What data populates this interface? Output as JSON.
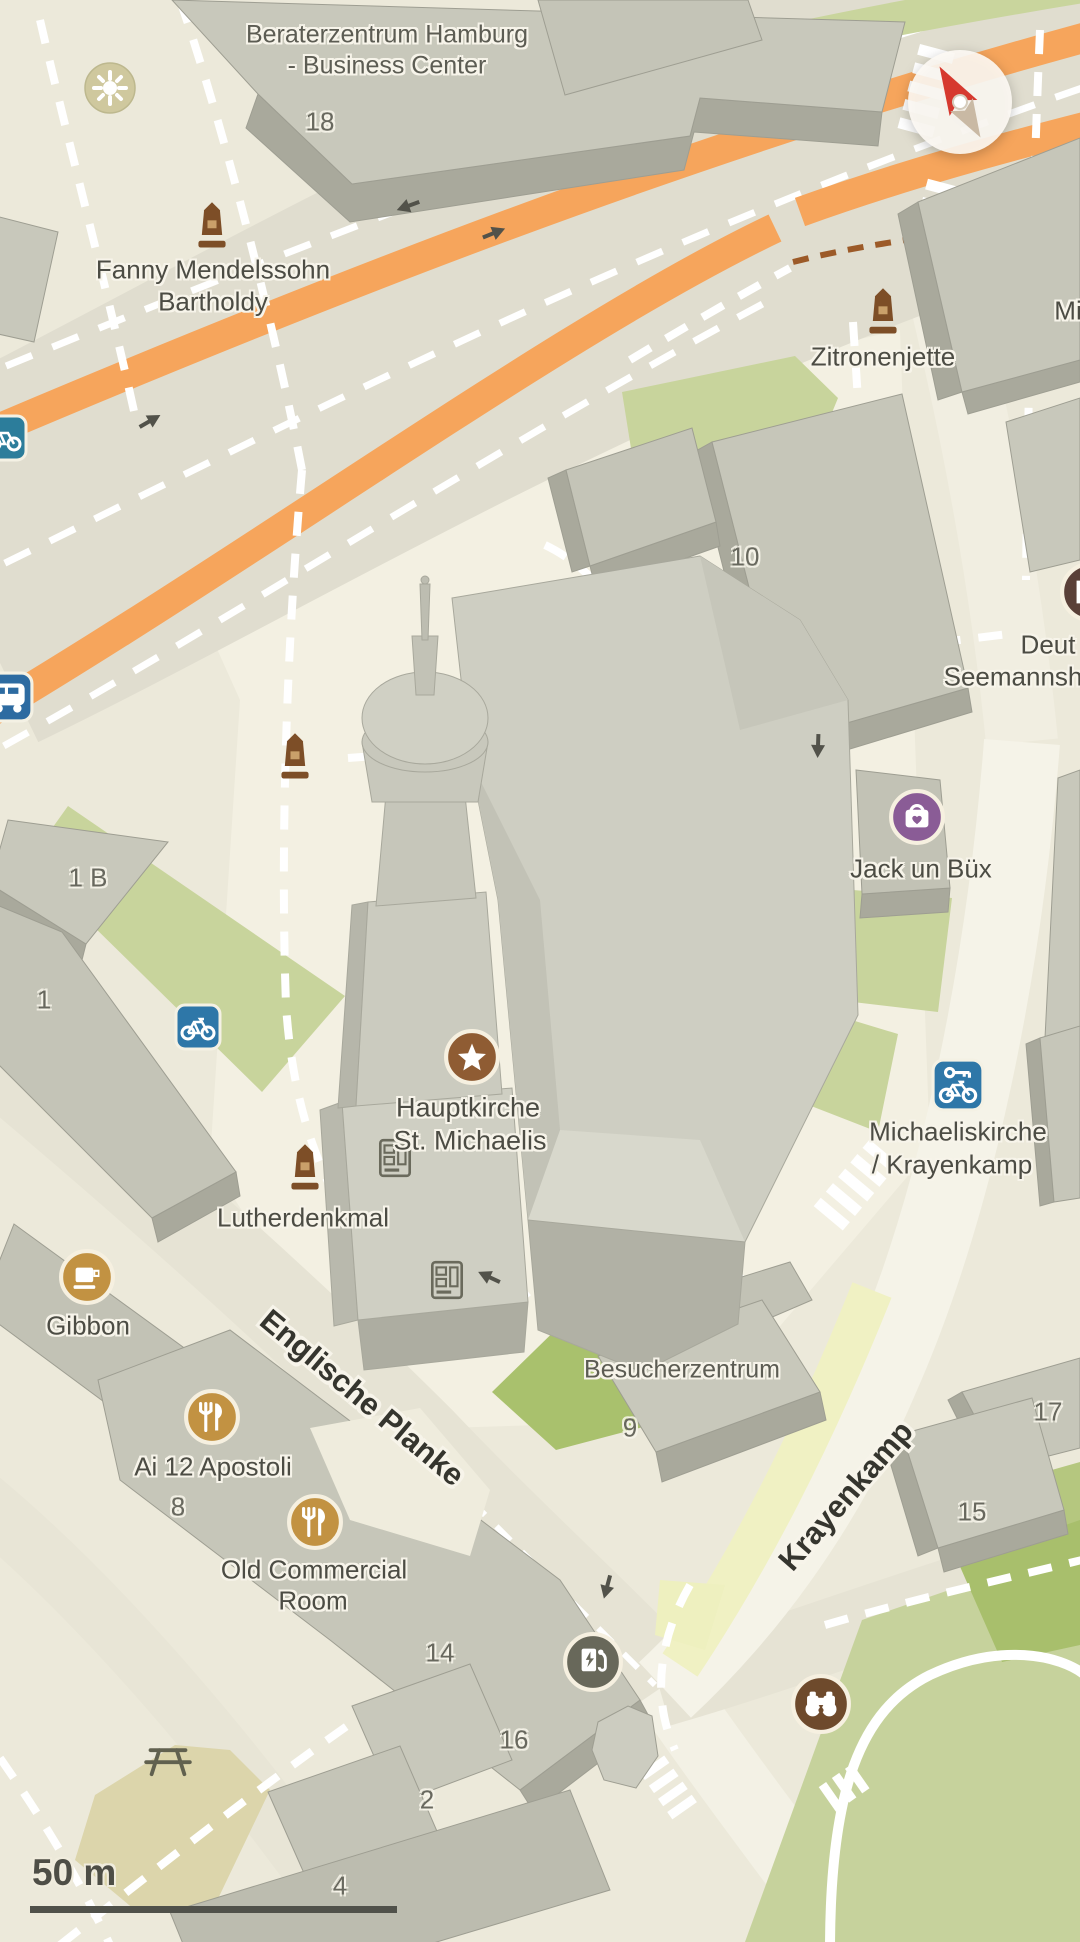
{
  "view": {
    "type": "3d-map",
    "city_area": "Hamburg – St. Michaelis"
  },
  "map_labels": {
    "beraterzentrum": {
      "line1": "Beraterzentrum Hamburg",
      "line2": "- Business Center"
    },
    "fanny": {
      "line1": "Fanny Mendelssohn",
      "line2": "Bartholdy"
    },
    "zitronenjette": {
      "text": "Zitronenjette"
    },
    "mi_truncated": {
      "text": "Mi"
    },
    "seemannsheim": {
      "line1": "Deut",
      "line2": "Seemannsh"
    },
    "jack_un_bux": {
      "text": "Jack un Büx"
    },
    "hauptkirche": {
      "line1": "Hauptkirche",
      "line2": "St. Michaelis"
    },
    "lutherdenkmal": {
      "text": "Lutherdenkmal"
    },
    "michaeliskirche": {
      "line1": "Michaeliskirche",
      "line2": "/ Krayenkamp"
    },
    "gibbon": {
      "text": "Gibbon"
    },
    "besucherzentrum": {
      "text": "Besucherzentrum"
    },
    "ai_12_apostoli": {
      "text": "Ai 12 Apostoli"
    },
    "old_commercial_room": {
      "line1": "Old Commercial",
      "line2": "Room"
    }
  },
  "street_labels": {
    "englische_planke": "Englische Planke",
    "krayenkamp": "Krayenkamp"
  },
  "house_numbers": {
    "n18": "18",
    "n10": "10",
    "n1b": "1 B",
    "n1": "1",
    "n9": "9",
    "n8": "8",
    "n14": "14",
    "n16": "16",
    "n2": "2",
    "n4": "4",
    "n15": "15",
    "n17": "17"
  },
  "scale_bar": {
    "label": "50 m"
  },
  "icon_glyphs": {
    "compass": "north-arrow",
    "monument": "obelisk-memorial",
    "star_poi": "star-landmark",
    "shopping": "bag-with-heart",
    "cafe": "coffee-cup",
    "restaurant": "fork-and-knife",
    "bike_rental": "key-and-bicycle",
    "bike_parking": "bicycle",
    "bus_stop": "bus",
    "ev_charging": "charging-station",
    "binoculars": "viewpoint-binoculars",
    "hotel_partial": "lodging",
    "picnic": "picnic-table",
    "fountain": "round-fountain",
    "vending": "ticket-machine"
  },
  "colors": {
    "background": "#ece9da",
    "plaza": "#f4f1e3",
    "road_orange": "#f6a55c",
    "green_area": "#c8d49c",
    "sports_green": "#c6d29c",
    "dark_green": "#a8bf6c",
    "pale_yellow": "#f0f1c3",
    "playground_tan": "#dcd5ab",
    "building_top": "#cbcbbe",
    "building_side": "#a9a99c",
    "poi_brown": "#8f5c33",
    "poi_gold": "#c29242",
    "poi_purple": "#8a5c96",
    "poi_blue": "#2e75a8",
    "monument_brown": "#7d4e27",
    "label_dark": "#4c4c44"
  }
}
